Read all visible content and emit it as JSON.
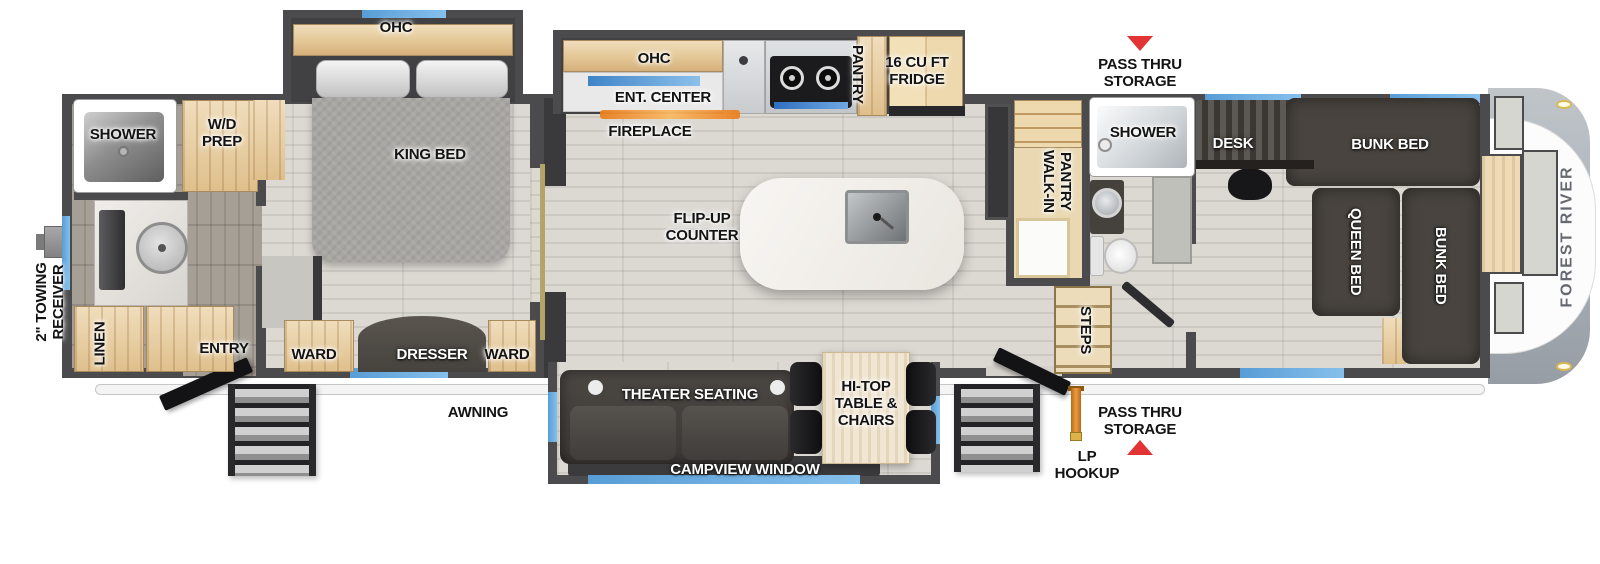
{
  "labels": {
    "towing_receiver": "2\" TOWING\nRECEIVER",
    "awning": "AWNING",
    "brand": "FOREST RIVER",
    "pass_thru_top": "PASS THRU\nSTORAGE",
    "pass_thru_bottom": "PASS THRU\nSTORAGE",
    "lp_hookup": "LP\nHOOKUP",
    "rear_shower": "SHOWER",
    "wd_prep": "W/D\nPREP",
    "linen": "LINEN",
    "entry": "ENTRY",
    "bedroom_ohc": "OHC",
    "king_bed": "KING BED",
    "ward_left": "WARD",
    "dresser": "DRESSER",
    "ward_right": "WARD",
    "kitchen_ohc": "OHC",
    "ent_center": "ENT. CENTER",
    "fireplace": "FIREPLACE",
    "pantry": "PANTRY",
    "fridge": "16 CU FT\nFRIDGE",
    "flip_up_counter": "FLIP-UP\nCOUNTER",
    "walk_in_pantry": "WALK-IN\nPANTRY",
    "mid_shower": "SHOWER",
    "steps": "STEPS",
    "desk": "DESK",
    "bunk_bed_top": "BUNK BED",
    "queen_bed": "QUEEN BED",
    "bunk_bed_side": "BUNK BED",
    "theater_seating": "THEATER SEATING",
    "hi_top": "HI-TOP\nTABLE &\nCHAIRS",
    "campview_window": "CAMPVIEW WINDOW"
  },
  "markers": {
    "pass_thru_top_arrow": "down",
    "pass_thru_bottom_arrow": "up"
  },
  "colors": {
    "wall": "#4b4b4d",
    "floor_light": "#d5d2cc",
    "floor_dark": "#9d978e",
    "wood": "#e6c globale996",
    "wood_cabinet": "#e6c996",
    "dark_furniture": "#49443f",
    "king_bed_gray": "#a8a6a2",
    "window_blue": "#64a7dc",
    "marker_red": "#e23434",
    "lp_orange": "#d88428",
    "brand_text": "#666a70",
    "awning_white": "#f4f4f4"
  }
}
